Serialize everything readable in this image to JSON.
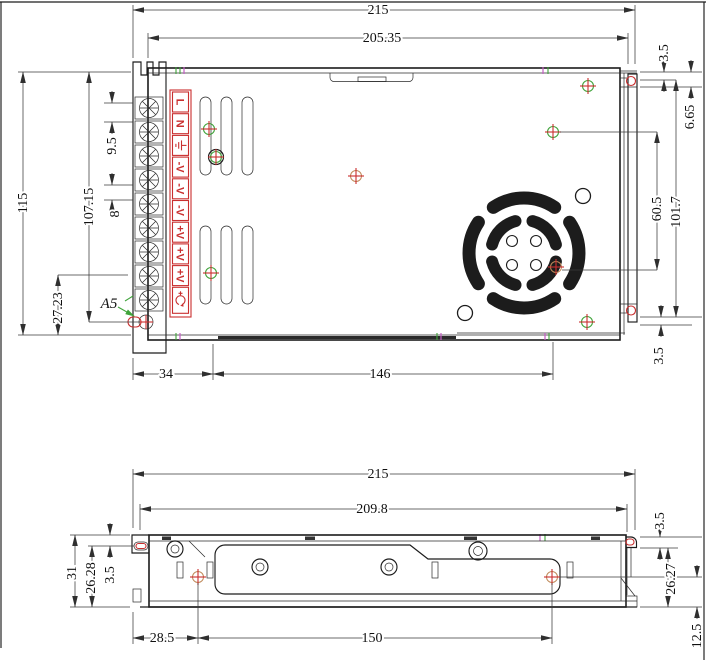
{
  "top_view": {
    "w_overall": "215",
    "w_cover": "205.35",
    "h_overall": "115",
    "h_cover": "107.15",
    "h_bottom": "27.23",
    "pitch_a": "9.5",
    "pitch_b": "8",
    "bottom_a": "34",
    "bottom_b": "146",
    "right_a": "3.5",
    "right_b": "6.65",
    "right_c": "60.5",
    "right_d": "101.7",
    "right_e": "3.5",
    "hole_callout": "A5",
    "terminals": [
      {
        "label": "L"
      },
      {
        "label": "N"
      },
      {
        "icon": "earth-ground-icon"
      },
      {
        "label": "-V"
      },
      {
        "label": "-V"
      },
      {
        "label": "-V"
      },
      {
        "label": "+V"
      },
      {
        "label": "+V"
      },
      {
        "label": "+V"
      },
      {
        "icon": "voltage-adjust-icon"
      }
    ]
  },
  "side_view": {
    "w_overall": "215",
    "w_top": "209.8",
    "h_overall": "31",
    "h_inner": "26.28",
    "left_slot": "3.5",
    "right_a": "3.5",
    "right_b": "26.27",
    "right_c": "12.5",
    "bottom_a": "28.5",
    "bottom_b": "150"
  },
  "colors": {
    "line": "#1c1c1c",
    "red_accent": "#c92f2f",
    "green_accent": "#3fa33a",
    "magenta_accent": "#c45ec4"
  }
}
